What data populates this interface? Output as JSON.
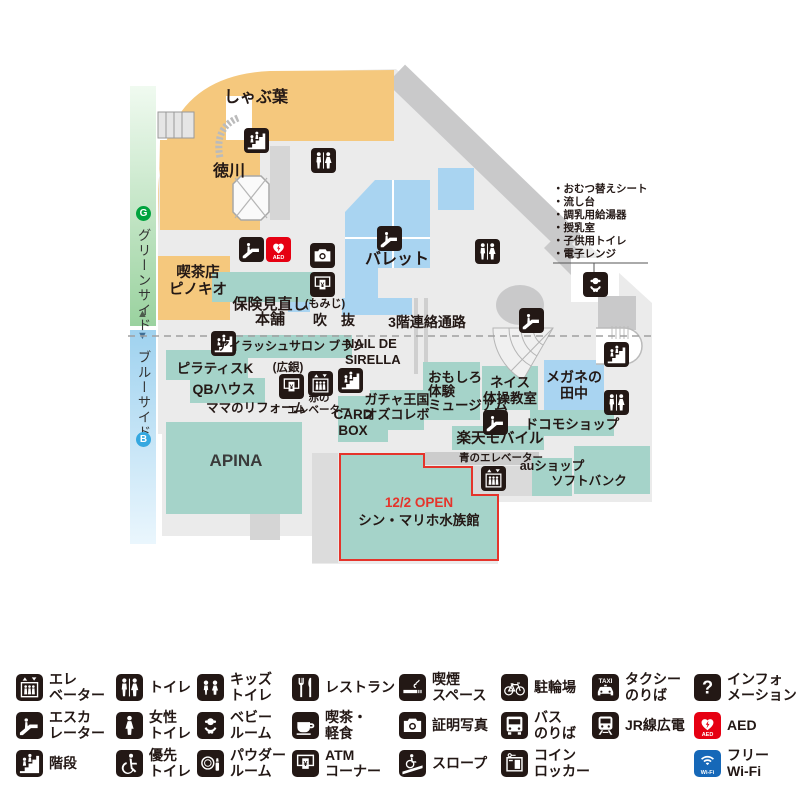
{
  "map": {
    "strip": {
      "green_badge": "G",
      "green_label": "グリーンサイド",
      "up_arrow": "▲",
      "down_arrow": "▼",
      "blue_label": "ブルーサイド",
      "blue_badge": "B"
    },
    "labels": {
      "shabuyo": "しゃぶ葉",
      "tokugawa": "徳川",
      "pinocchio": "喫茶店\nピノキオ",
      "hoken_line1": "保険見直し",
      "hoken_momiji": "(もみじ)",
      "hoken_line2": "本舗",
      "fukinuke": "吹　抜",
      "renraku": "3階連絡通路",
      "palette": "バレット",
      "eyelash": "アイラッシュサロン ブラン",
      "nail": "NAIL DE\nSIRELLA",
      "pilates": "ピラティスK",
      "qb": "QBハウス",
      "hirogin": "(広銀)",
      "red_elevator": "赤の\nエレベーター",
      "mama": "ママのリフォーム",
      "cardbox": "CARD\nBOX",
      "gacha": "ガチャ王国\nオズコレボ",
      "omoshiro": "おもしろ\n体験\nミュージアム",
      "neisu": "ネイス\n体操教室",
      "megane": "メガネの\n田中",
      "docomo": "ドコモショップ",
      "rakuten": "楽天モバイル",
      "blue_elevator": "青のエレベーター",
      "au": "auショップ",
      "softbank": "ソフトバンク",
      "apina": "APINA",
      "aquarium_open": "12/2 OPEN",
      "aquarium_name": "シン・マリホ水族館",
      "baby_notes": "・おむつ替えシート\n・流し台\n・調乳用給湯器\n・授乳室\n・子供用トイレ\n・電子レンジ"
    }
  },
  "icons": {
    "aed_text": "AED",
    "taxi_text": "TAXI",
    "wifi_text": "Wi-Fi"
  },
  "legend": {
    "columns": [
      [
        {
          "icon": "elevator",
          "label": "エレ\nベーター"
        },
        {
          "icon": "escalator",
          "label": "エスカ\nレーター"
        },
        {
          "icon": "stairs",
          "label": "階段"
        }
      ],
      [
        {
          "icon": "toilet",
          "label": "トイレ"
        },
        {
          "icon": "female-toilet",
          "label": "女性\nトイレ"
        },
        {
          "icon": "priority-toilet",
          "label": "優先\nトイレ"
        }
      ],
      [
        {
          "icon": "kids-toilet",
          "label": "キッズ\nトイレ"
        },
        {
          "icon": "baby-room",
          "label": "ベビー\nルーム"
        },
        {
          "icon": "powder-room",
          "label": "パウダー\nルーム"
        }
      ],
      [
        {
          "icon": "restaurant",
          "label": "レストラン"
        },
        {
          "icon": "cafe",
          "label": "喫茶・\n軽食"
        },
        {
          "icon": "atm",
          "label": "ATM\nコーナー"
        }
      ],
      [
        {
          "icon": "smoking",
          "label": "喫煙\nスペース"
        },
        {
          "icon": "photo",
          "label": "証明写真"
        },
        {
          "icon": "slope",
          "label": "スロープ"
        }
      ],
      [
        {
          "icon": "bicycle",
          "label": "駐輪場"
        },
        {
          "icon": "bus",
          "label": "バス\nのりば"
        },
        {
          "icon": "locker",
          "label": "コイン\nロッカー"
        }
      ],
      [
        {
          "icon": "taxi",
          "label": "タクシー\nのりば"
        },
        {
          "icon": "train",
          "label": "JR線広電"
        }
      ],
      [
        {
          "icon": "information",
          "label": "インフォ\nメーション"
        },
        {
          "icon": "aed",
          "label": "AED"
        },
        {
          "icon": "wifi",
          "label": "フリー\nWi-Fi"
        }
      ]
    ]
  },
  "colors": {
    "store_teal": "#a5d3c9",
    "store_blue": "#a9d4f1",
    "store_orange": "#f5c87d",
    "accent_red": "#e5342b",
    "icon_black": "#231815",
    "aed_red": "#e60012",
    "wifi_blue": "#1668b8",
    "green_badge": "#00a33e",
    "blue_badge": "#35a8e0"
  }
}
